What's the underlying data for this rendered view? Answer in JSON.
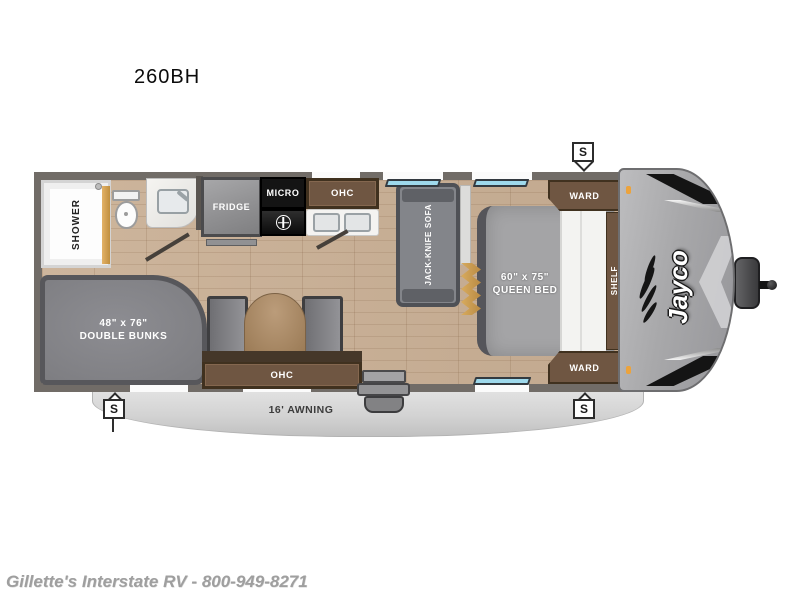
{
  "title": "260BH",
  "floorplan": {
    "brand": "Jayco",
    "awning_label": "16' AWNING",
    "speaker_marker": "S",
    "labels": {
      "shower": "SHOWER",
      "fridge": "FRIDGE",
      "micro": "MICRO",
      "kitchen_ohc": "OHC",
      "sofa": "JACK-KNIFE SOFA",
      "ward_top": "WARD",
      "ward_bottom": "WARD",
      "shelf": "SHELF",
      "dinette_ohc": "OHC"
    },
    "queen_bed": {
      "size": "60\" x 75\"",
      "name": "QUEEN BED"
    },
    "double_bunks": {
      "size": "48\" x 76\"",
      "name": "DOUBLE BUNKS"
    },
    "colors": {
      "floor": "#c9b097",
      "wall": "#716c67",
      "cabinet_wood": "#6f5642",
      "window_glass": "#9ed9ec",
      "awning": "#d3d3d3",
      "front_cap": "#a8a8aa",
      "accent_gold": "#d8ab5e"
    }
  },
  "footer": {
    "dealer_line": "Gillette's Interstate RV - 800-949-8271"
  }
}
